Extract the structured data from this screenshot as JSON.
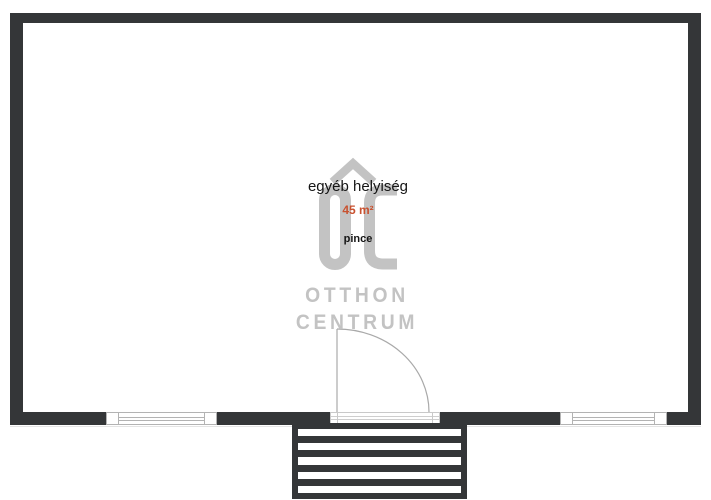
{
  "plan": {
    "room": {
      "name": "egyéb helyiség",
      "area": "45 m²",
      "level": "pince"
    },
    "watermark": {
      "monogram": "OC",
      "line1": "OTTHON",
      "line2": "CENTRUM"
    },
    "colors": {
      "wall": "#343638",
      "accent": "#c8512f",
      "watermark": "#c3c3c3",
      "line": "#b3b3b3"
    }
  }
}
